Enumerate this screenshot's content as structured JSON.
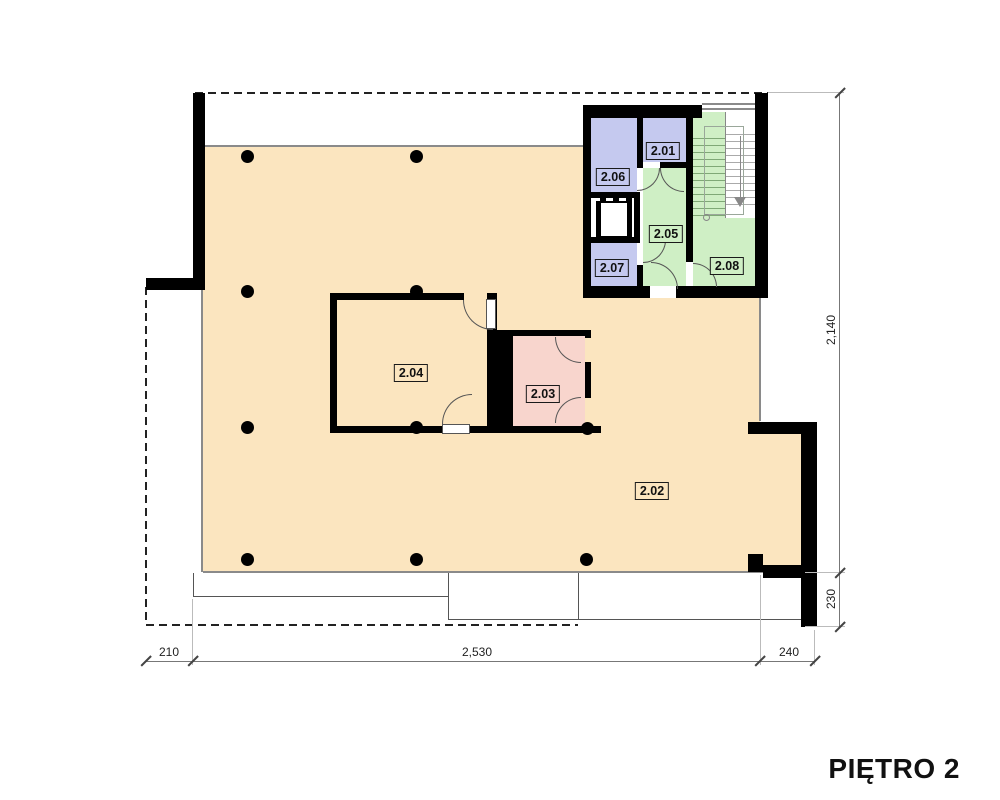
{
  "title": "PIĘTRO 2",
  "rooms": {
    "r201": {
      "label": "2.01",
      "color": "#c5c9ef"
    },
    "r202": {
      "label": "2.02",
      "color": "#fbe5bf"
    },
    "r203": {
      "label": "2.03",
      "color": "#f8d5cd"
    },
    "r204": {
      "label": "2.04",
      "color": "#fbe5bf"
    },
    "r205": {
      "label": "2.05",
      "color": "#cfefc5"
    },
    "r206": {
      "label": "2.06",
      "color": "#c5c9ef"
    },
    "r207": {
      "label": "2.07",
      "color": "#c5c9ef"
    },
    "r208": {
      "label": "2.08",
      "color": "#cfefc5"
    }
  },
  "dimensions": {
    "bottom_left": "210",
    "bottom_middle": "2,530",
    "bottom_right": "240",
    "right_main": "2,140",
    "right_lower": "230"
  },
  "colors": {
    "wall": "#000000",
    "floor_main": "#fbe5bf",
    "room_pink": "#f8d5cd",
    "room_blue": "#c5c9ef",
    "room_green": "#cfefc5",
    "dimension_line": "#777777"
  }
}
